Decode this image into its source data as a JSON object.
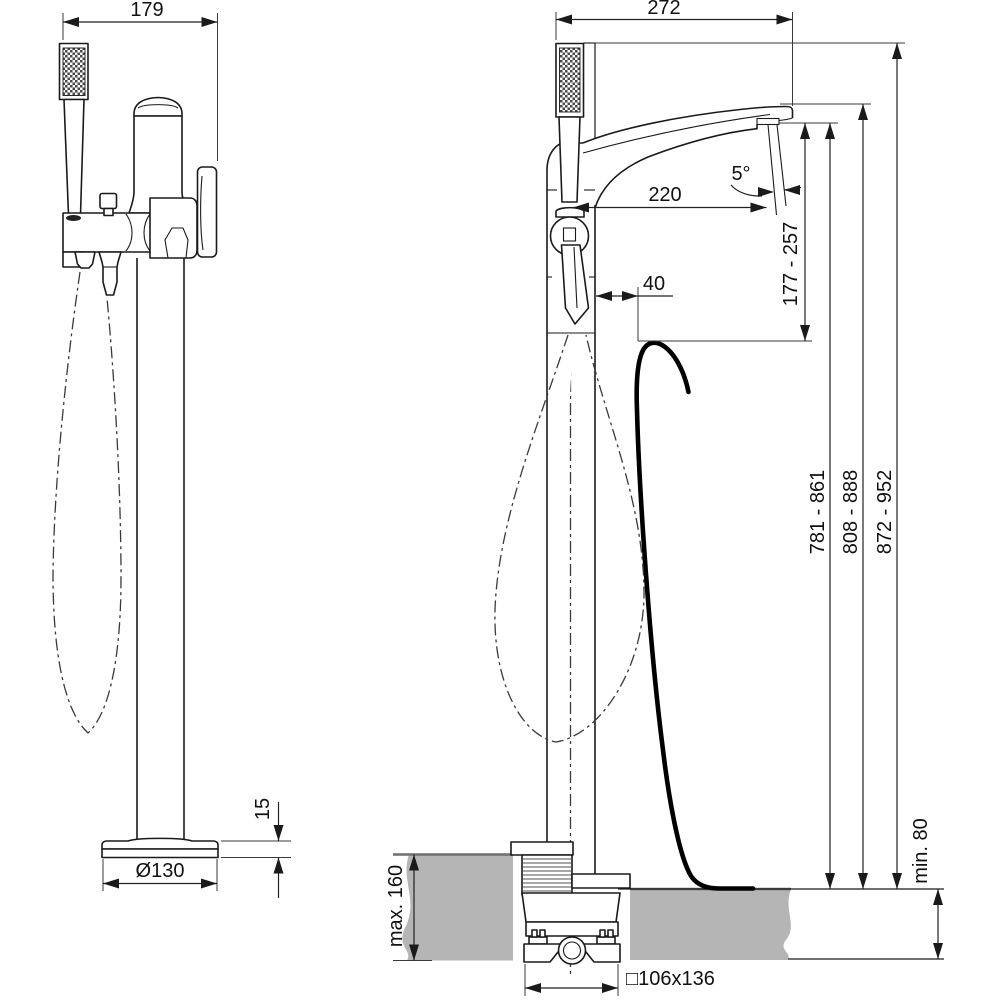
{
  "drawing": {
    "kind": "technical-dimension-drawing",
    "subject": "freestanding floor-mounted bath shower mixer, front and side views",
    "labels": {
      "front_width": "179",
      "front_base_diameter": "Ø130",
      "front_base_height": "15",
      "side_depth": "272",
      "spout_reach": "220",
      "spout_angle": "5°",
      "hose_offset": "40",
      "outlet_to_rim": "177 - 257",
      "outlet_height": "781 - 861",
      "spout_top_height": "808 - 888",
      "overall_height": "872 - 952",
      "floor_max": "max. 160",
      "floor_min": "min. 80",
      "rough_in": "□106x136"
    },
    "colors": {
      "line": "#1a1a1a",
      "floor_fill": "#b5b5b5",
      "floor_edge": "#6f6f6f",
      "background": "#ffffff"
    }
  }
}
